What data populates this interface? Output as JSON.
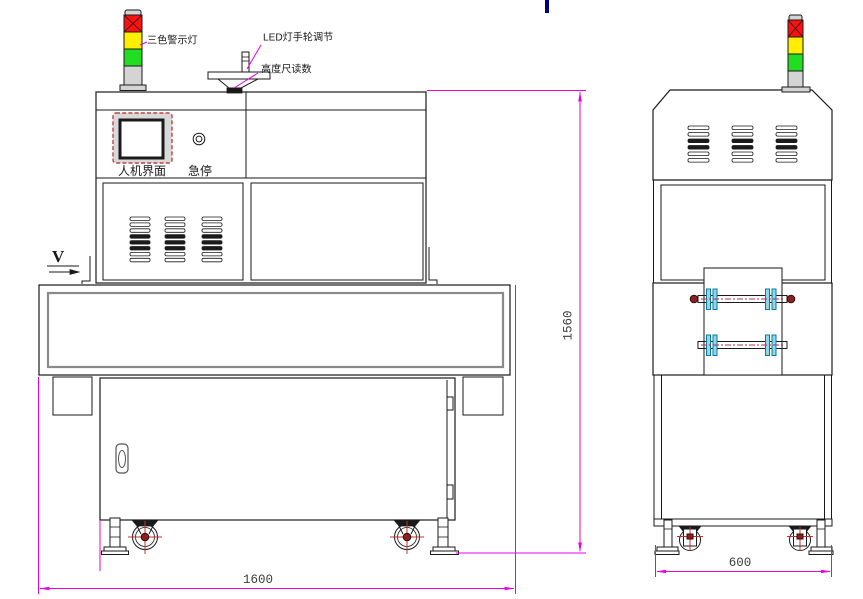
{
  "drawing_type": "machine engineering drawing, front and side elevation views",
  "callouts": {
    "tricolor_light": "三色警示灯",
    "led_handwheel": "LED灯手轮调节",
    "height_gauge": "高度尺读数"
  },
  "panel": {
    "hmi_label": "人机界面",
    "estop_label": "急停"
  },
  "direction": {
    "label": "V"
  },
  "dimensions": {
    "overall_length": "1600",
    "overall_height": "1560",
    "overall_depth": "600"
  },
  "colors": {
    "outline": "#1a1a1a",
    "dim": "#e800e8",
    "red": "#ff1010",
    "yellow": "#ffee00",
    "green": "#22dd22",
    "tower_gray": "#d4d4d4",
    "flange": "#8ed8ea",
    "flange_stroke": "#0d7a9a",
    "roller_center": "#b03060",
    "screw": "#8a2020",
    "caster_red": "#c03030",
    "hmi_frame": "#c04040",
    "conveyor_inner": "#8a8a8a",
    "cursor": "#00007a"
  }
}
